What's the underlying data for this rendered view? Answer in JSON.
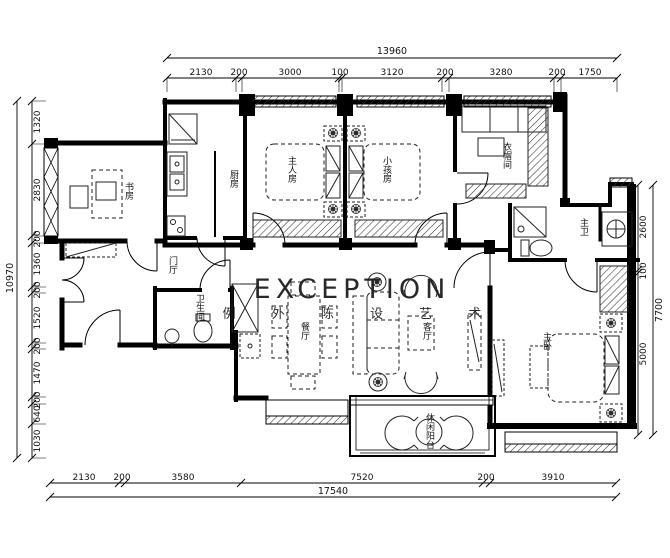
{
  "watermark": {
    "title": "EXCEPTION",
    "subtitle": "例 外 陈 设 艺 术",
    "color": "#f2c6d7"
  },
  "rooms": {
    "study": "书房",
    "kitchen": "厨房",
    "master_room": "主人房",
    "kids_room": "小孩房",
    "cloakroom": "衣帽间",
    "master_bath": "主卫",
    "hall": "门厅",
    "guest_bath": "卫生间",
    "dining": "餐厅",
    "living": "客厅",
    "master_bedroom": "主卧",
    "balcony": "休闲阳台"
  },
  "dims": {
    "top": {
      "total": "13960",
      "segments": [
        "2130",
        "200",
        "3000",
        "100",
        "3120",
        "200",
        "3280",
        "200",
        "1750"
      ]
    },
    "bottom": {
      "total": "17540",
      "segments": [
        "2130",
        "200",
        "3580",
        "7520",
        "200",
        "3910"
      ]
    },
    "left": {
      "total": "10970",
      "segments": [
        "1320",
        "2830",
        "200",
        "1360",
        "200",
        "1520",
        "200",
        "1470",
        "200",
        "640",
        "1030"
      ]
    },
    "right": {
      "total": "7700",
      "segments": [
        "2600",
        "100",
        "5000"
      ]
    }
  }
}
